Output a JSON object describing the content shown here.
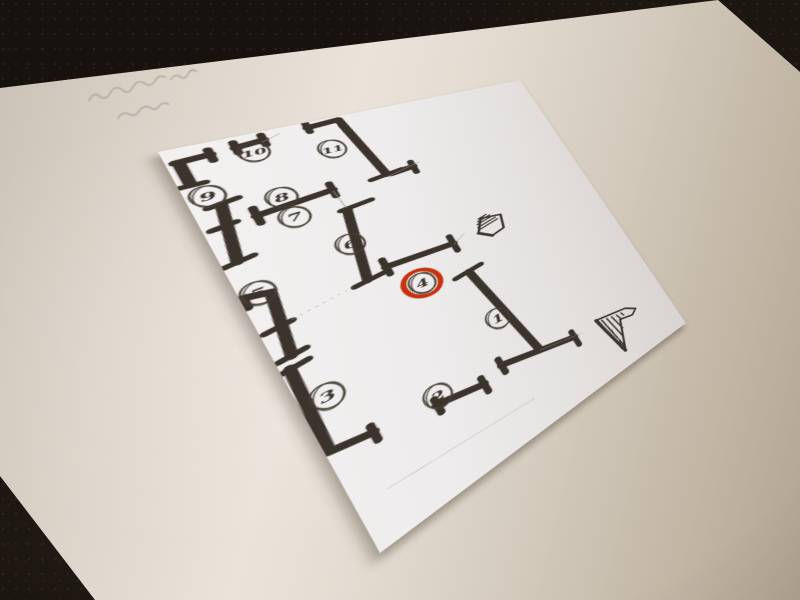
{
  "scene": {
    "description": "Photograph of a hand-drawn floor plan sketch on a small white sheet lying on a larger cream paper on dark carpet; numbered circled positions, position 4 highlighted with a red ring; faint illegible pencil handwriting on the large paper; two hatched entrance-arrow symbols",
    "colors": {
      "carpet": "#17120e",
      "large_paper": "#ddd5ca",
      "plan_sheet": "#efeceb",
      "ink": "#3b342c",
      "circle_ink": "#463e35",
      "pencil": "#a2978c",
      "highlight_red": "#c8330f"
    }
  },
  "plan": {
    "sheet_size": [
      340,
      560
    ],
    "markers": [
      {
        "label": "1",
        "x": 160,
        "y": 390,
        "highlighted": false
      },
      {
        "label": "2",
        "x": 83,
        "y": 443,
        "highlighted": false
      },
      {
        "label": "3",
        "x": 18,
        "y": 375,
        "highlighted": false
      },
      {
        "label": "4",
        "x": 119,
        "y": 294,
        "highlighted": true
      },
      {
        "label": "5",
        "x": 12,
        "y": 222,
        "highlighted": false
      },
      {
        "label": "6",
        "x": 85,
        "y": 202,
        "highlighted": false
      },
      {
        "label": "7",
        "x": 59,
        "y": 139,
        "highlighted": false
      },
      {
        "label": "8",
        "x": 58,
        "y": 106,
        "highlighted": false
      },
      {
        "label": "9",
        "x": 14,
        "y": 77,
        "highlighted": false
      },
      {
        "label": "10",
        "x": 57,
        "y": 29,
        "highlighted": false
      },
      {
        "label": "11",
        "x": 113,
        "y": 52,
        "highlighted": false
      }
    ],
    "walls": {
      "stroke_width": 8.5,
      "bar_width": 6.5,
      "segments": [
        [
          6,
          21,
          29,
          19
        ],
        [
          8,
          21,
          8,
          56
        ],
        [
          47,
          17,
          68,
          14
        ],
        [
          104,
          9,
          131,
          6
        ],
        [
          131,
          6,
          143,
          116
        ],
        [
          147,
          117,
          169,
          115
        ],
        [
          19,
          93,
          10,
          175
        ],
        [
          36,
          122,
          95,
          116
        ],
        [
          97,
          151,
          82,
          260
        ],
        [
          100,
          252,
          162,
          257
        ],
        [
          3,
          222,
          19,
          227
        ],
        [
          19,
          227,
          11,
          312
        ],
        [
          6,
          325,
          3,
          432
        ],
        [
          3,
          434,
          32,
          441
        ],
        [
          79,
          452,
          119,
          462
        ],
        [
          140,
          452,
          215,
          474
        ],
        [
          160,
          307,
          178,
          462
        ]
      ],
      "bars": [
        [
          29,
          11,
          29,
          29
        ],
        [
          0,
          57,
          17,
          57
        ],
        [
          47,
          8,
          47,
          26
        ],
        [
          68,
          5,
          68,
          23
        ],
        [
          104,
          1,
          104,
          17
        ],
        [
          128,
          118,
          158,
          114
        ],
        [
          169,
          106,
          169,
          126
        ],
        [
          10,
          94,
          31,
          90
        ],
        [
          1,
          177,
          21,
          173
        ],
        [
          5,
          125,
          22,
          122
        ],
        [
          36,
          110,
          36,
          134
        ],
        [
          95,
          105,
          95,
          127
        ],
        [
          92,
          151,
          119,
          148
        ],
        [
          71,
          262,
          99,
          258
        ],
        [
          100,
          240,
          100,
          264
        ],
        [
          162,
          244,
          162,
          270
        ],
        [
          2,
          221,
          2,
          236
        ],
        [
          3,
          274,
          22,
          271
        ],
        [
          2,
          313,
          21,
          310
        ],
        [
          1,
          327,
          19,
          324
        ],
        [
          32,
          432,
          32,
          452
        ],
        [
          79,
          444,
          79,
          464
        ],
        [
          119,
          452,
          119,
          474
        ],
        [
          140,
          442,
          140,
          464
        ],
        [
          215,
          464,
          215,
          488
        ],
        [
          146,
          309,
          174,
          304
        ]
      ]
    },
    "pencil_lines": [
      {
        "pts": [
          95,
          118,
          97,
          149
        ],
        "opacity": 0.55,
        "dash": ""
      },
      {
        "pts": [
          22,
          270,
          70,
          261
        ],
        "opacity": 0.5,
        "dash": "2,4"
      },
      {
        "pts": [
          143,
          120,
          177,
          110
        ],
        "opacity": 0.6,
        "dash": ""
      },
      {
        "pts": [
          162,
          259,
          177,
          248
        ],
        "opacity": 0.45,
        "dash": ""
      },
      {
        "pts": [
          178,
          463,
          224,
          475
        ],
        "opacity": 0.4,
        "dash": ""
      },
      {
        "pts": [
          22,
          506,
          150,
          517
        ],
        "opacity": 0.3,
        "dash": ""
      },
      {
        "pts": [
          66,
          17,
          82,
          9
        ],
        "opacity": 0.5,
        "dash": ""
      }
    ],
    "hatches": [
      {
        "name": "entrance-arrow-small",
        "outline": [
          [
            189,
            257
          ],
          [
            199,
            235
          ],
          [
            220,
            241
          ],
          [
            215,
            264
          ],
          [
            200,
            269
          ]
        ],
        "thick_edge": [
          189,
          257,
          200,
          269
        ],
        "lines": [
          [
            192,
            252,
            215,
            246
          ],
          [
            191,
            248,
            214,
            242
          ],
          [
            192,
            243,
            212,
            238
          ],
          [
            194,
            239,
            210,
            235
          ],
          [
            196,
            235,
            207,
            232
          ]
        ]
      },
      {
        "name": "entrance-arrow-large",
        "outline": [
          [
            245,
            470
          ],
          [
            283,
            479
          ],
          [
            294,
            489
          ],
          [
            286,
            495
          ],
          [
            270,
            490
          ],
          [
            255,
            537
          ]
        ],
        "thick_edge": [
          245,
          470,
          255,
          537
        ],
        "lines": [
          [
            247,
            472,
            253,
            533
          ],
          [
            251,
            474,
            257,
            530
          ],
          [
            257,
            476,
            262,
            517
          ],
          [
            263,
            478,
            267,
            505
          ],
          [
            269,
            480,
            272,
            492
          ],
          [
            275,
            481,
            277,
            488
          ]
        ]
      }
    ]
  }
}
